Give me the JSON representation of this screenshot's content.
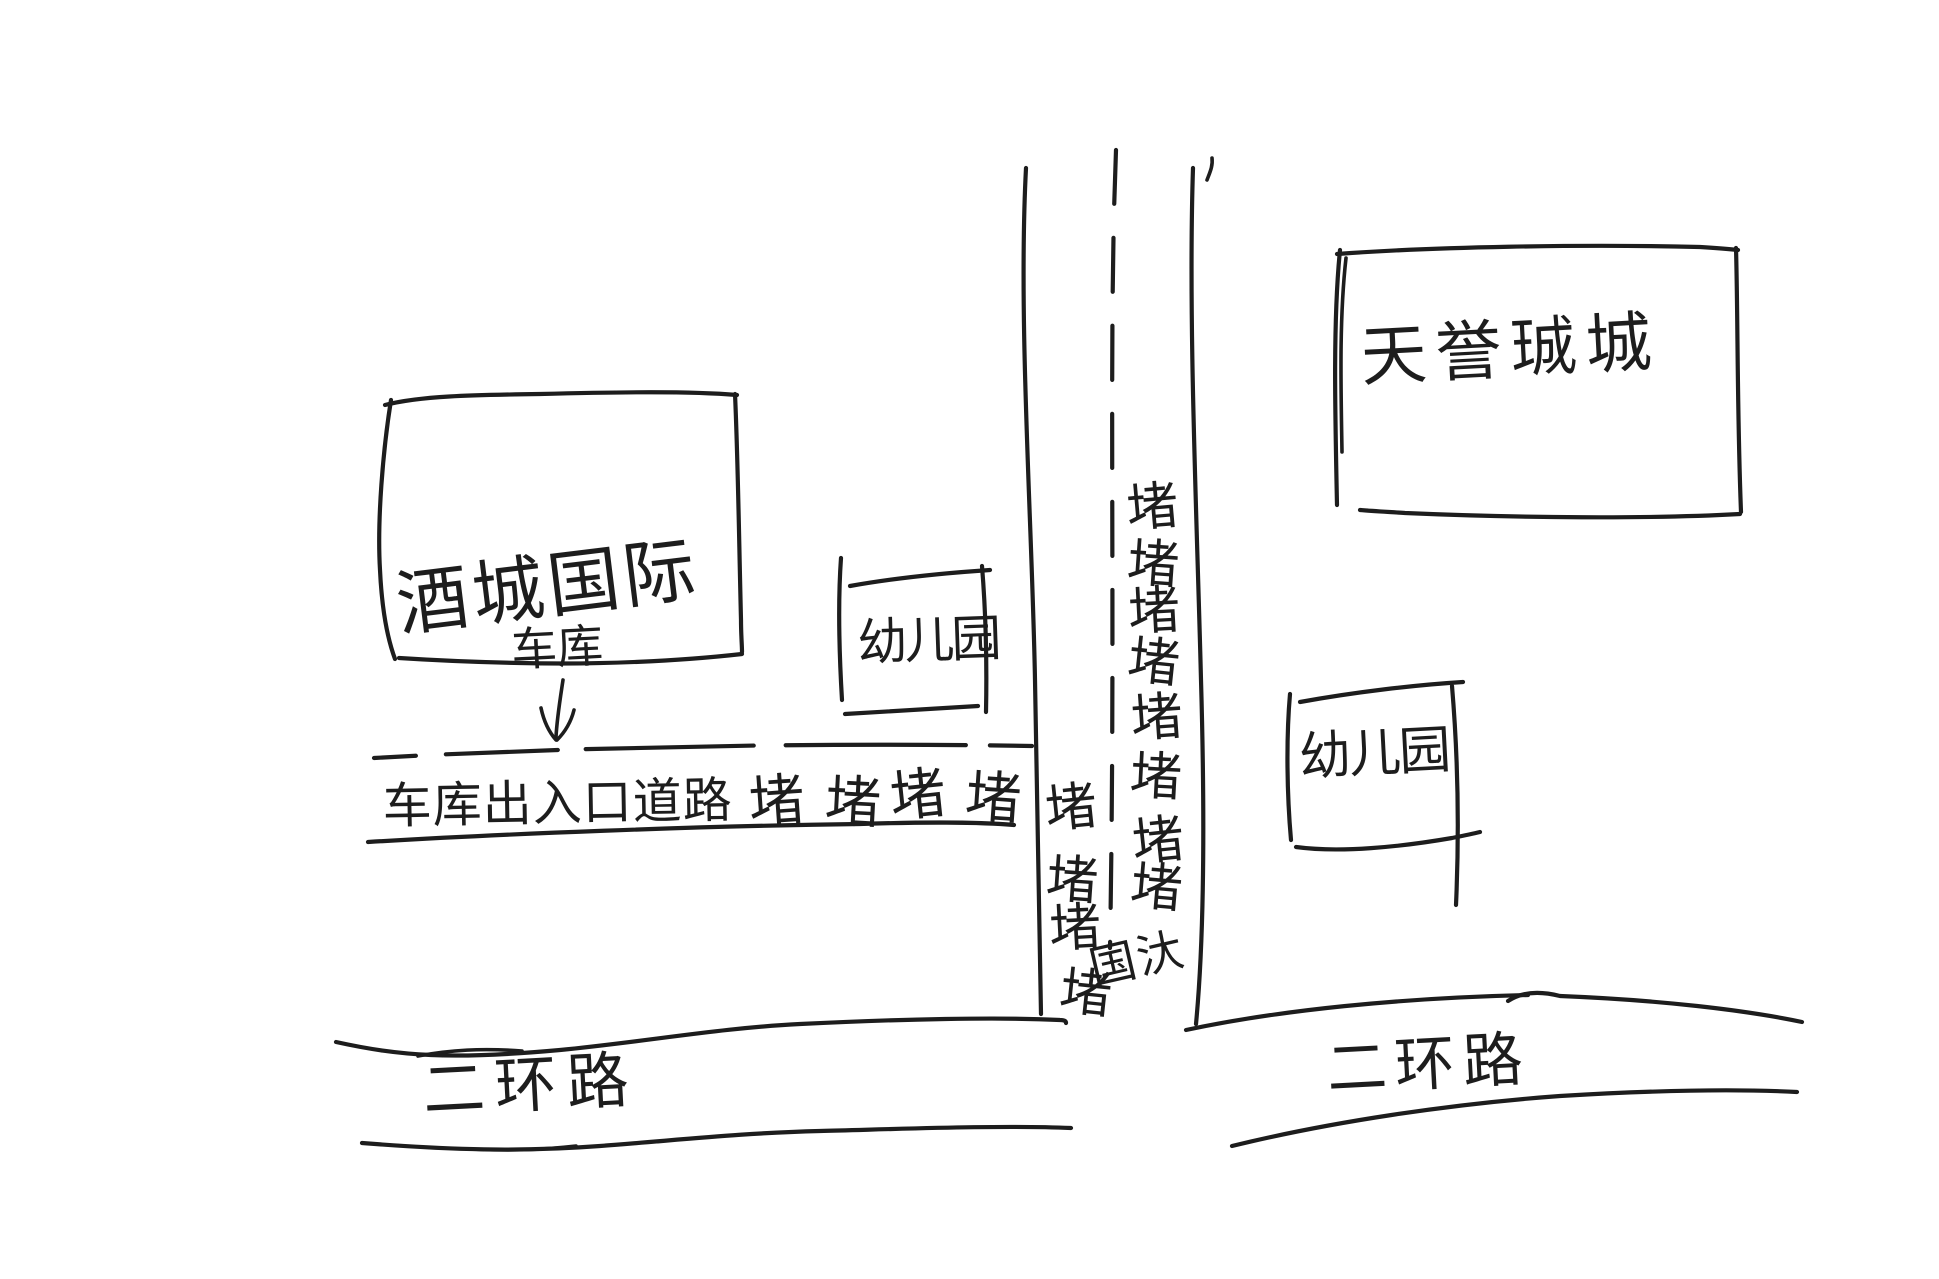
{
  "colors": {
    "ink": "#1d1d1d",
    "paper": "#ffffff"
  },
  "buildings": {
    "left_building_label": "酒城国际",
    "top_right_building_label": "天誉珹城",
    "left_kindergarten_label": "幼儿园",
    "right_kindergarten_label": "幼儿园"
  },
  "garage": {
    "label": "车库",
    "arrow_icon": "down-arrow"
  },
  "garage_road": {
    "name_label": "车库出入口道路",
    "jam_labels": [
      "堵",
      "堵",
      "堵",
      "堵"
    ]
  },
  "vertical_road": {
    "left_lane_jam_labels": [
      "堵",
      "堵",
      "堵",
      "堵"
    ],
    "right_lane_jam_labels": [
      "堵",
      "堵",
      "堵",
      "堵",
      "堵",
      "堵",
      "堵",
      "堵"
    ],
    "note_label": "国汏"
  },
  "ring_road": {
    "left_label": "二环路",
    "right_label": "二环路"
  }
}
